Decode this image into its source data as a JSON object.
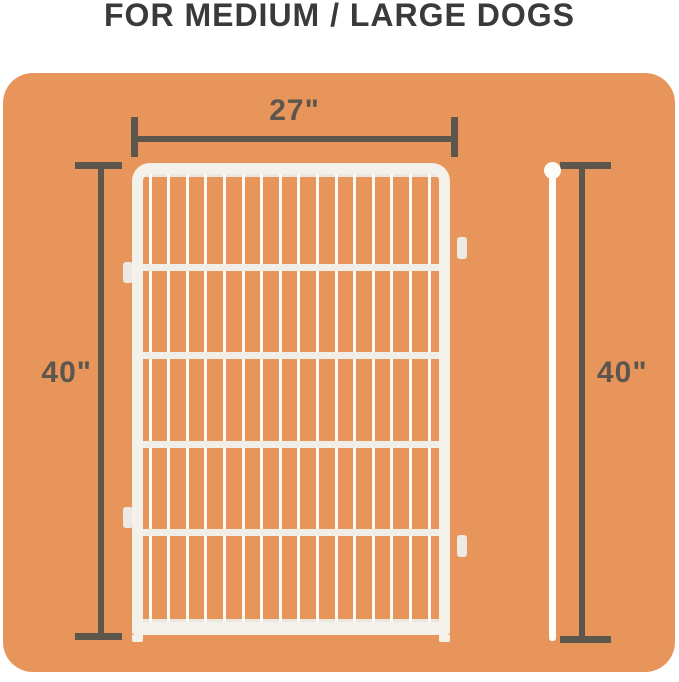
{
  "header": {
    "title": "FOR MEDIUM / LARGE DOGS"
  },
  "dimensions": {
    "width": {
      "label": "27\""
    },
    "height_left": {
      "label": "40\""
    },
    "height_right": {
      "label": "40\""
    }
  },
  "panel": {
    "vertical_wires": 16,
    "horizontal_crossbars": 4,
    "side_tabs": 4
  },
  "colors": {
    "page_bg": "#FFFFFF",
    "title": "#3A3A3A",
    "board_orange": "#E8955B",
    "dimension_gray": "#5D564D",
    "frame_white": "#F3F1EA",
    "wire_white": "#FBFAF6",
    "crossbar_white": "#F0EEE7",
    "edgewire_white": "#EAE7DF",
    "tab_white": "#ECEAE2",
    "pole_white": "#FDFCF8"
  }
}
